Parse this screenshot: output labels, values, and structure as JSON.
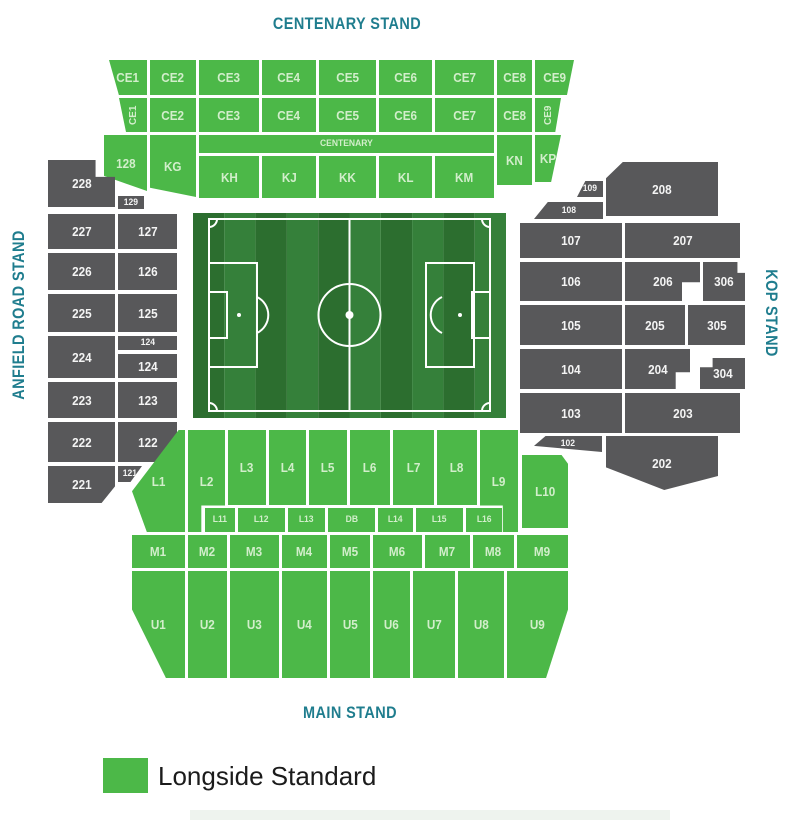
{
  "stands": {
    "centenary": "CENTENARY STAND",
    "main": "MAIN STAND",
    "anfield_road": "ANFIELD ROAD STAND",
    "kop": "KOP STAND"
  },
  "legend": {
    "items": [
      {
        "label": "Longside Standard",
        "color": "#4cb848"
      }
    ]
  },
  "colors": {
    "available": "#4cb848",
    "unavailable": "#58585a",
    "stand_title": "#1f7d8e",
    "label_on_green": "#d2eecb",
    "label_on_gray": "#f4f4f4",
    "pitch_stripe_dark": "#2c6e2f",
    "pitch_stripe_light": "#35803a",
    "pitch_lines": "#ffffff",
    "legend_text": "#1b1b1b"
  },
  "sections": [
    {
      "label": "CE1",
      "x": 109,
      "y": 60,
      "w": 38,
      "h": 35,
      "status": "available",
      "clip": "polygon(0% 0%,100% 0%,100% 100%,26% 100%)"
    },
    {
      "label": "CE2",
      "x": 150,
      "y": 60,
      "w": 46,
      "h": 35,
      "status": "available"
    },
    {
      "label": "CE3",
      "x": 199,
      "y": 60,
      "w": 60,
      "h": 35,
      "status": "available"
    },
    {
      "label": "CE4",
      "x": 262,
      "y": 60,
      "w": 54,
      "h": 35,
      "status": "available"
    },
    {
      "label": "CE5",
      "x": 319,
      "y": 60,
      "w": 57,
      "h": 35,
      "status": "available"
    },
    {
      "label": "CE6",
      "x": 379,
      "y": 60,
      "w": 53,
      "h": 35,
      "status": "available"
    },
    {
      "label": "CE7",
      "x": 435,
      "y": 60,
      "w": 59,
      "h": 35,
      "status": "available"
    },
    {
      "label": "CE8",
      "x": 497,
      "y": 60,
      "w": 35,
      "h": 35,
      "status": "available"
    },
    {
      "label": "CE9",
      "x": 535,
      "y": 60,
      "w": 39,
      "h": 35,
      "status": "available",
      "clip": "polygon(0% 0%,100% 0%,82% 100%,0% 100%)"
    },
    {
      "label": "CE1",
      "x": 119,
      "y": 98,
      "w": 28,
      "h": 34,
      "status": "available",
      "vertical": true,
      "clip": "polygon(0% 0%,100% 0%,100% 100%,25% 100%)"
    },
    {
      "label": "CE2",
      "x": 150,
      "y": 98,
      "w": 46,
      "h": 34,
      "status": "available"
    },
    {
      "label": "CE3",
      "x": 199,
      "y": 98,
      "w": 60,
      "h": 34,
      "status": "available"
    },
    {
      "label": "CE4",
      "x": 262,
      "y": 98,
      "w": 54,
      "h": 34,
      "status": "available"
    },
    {
      "label": "CE5",
      "x": 319,
      "y": 98,
      "w": 57,
      "h": 34,
      "status": "available"
    },
    {
      "label": "CE6",
      "x": 379,
      "y": 98,
      "w": 53,
      "h": 34,
      "status": "available"
    },
    {
      "label": "CE7",
      "x": 435,
      "y": 98,
      "w": 59,
      "h": 34,
      "status": "available"
    },
    {
      "label": "CE8",
      "x": 497,
      "y": 98,
      "w": 35,
      "h": 34,
      "status": "available"
    },
    {
      "label": "CE9",
      "x": 535,
      "y": 98,
      "w": 26,
      "h": 34,
      "status": "available",
      "vertical": true,
      "clip": "polygon(0% 0%,100% 0%,78% 100%,0% 100%)"
    },
    {
      "label": "128",
      "x": 104,
      "y": 135,
      "w": 43,
      "h": 56,
      "status": "available",
      "clip": "polygon(0% 0%,100% 0%,100% 100%,0% 73%)"
    },
    {
      "label": "KG",
      "x": 150,
      "y": 135,
      "w": 46,
      "h": 62,
      "status": "available",
      "clip": "polygon(0% 0%,100% 0%,100% 100%,0% 85%)"
    },
    {
      "label": "CENTENARY",
      "x": 199,
      "y": 135,
      "w": 295,
      "h": 18,
      "status": "available",
      "small": true
    },
    {
      "label": "KH",
      "x": 199,
      "y": 156,
      "w": 60,
      "h": 42,
      "status": "available"
    },
    {
      "label": "KJ",
      "x": 262,
      "y": 156,
      "w": 54,
      "h": 42,
      "status": "available"
    },
    {
      "label": "KK",
      "x": 319,
      "y": 156,
      "w": 57,
      "h": 42,
      "status": "available"
    },
    {
      "label": "KL",
      "x": 379,
      "y": 156,
      "w": 53,
      "h": 42,
      "status": "available"
    },
    {
      "label": "KM",
      "x": 435,
      "y": 156,
      "w": 59,
      "h": 42,
      "status": "available"
    },
    {
      "label": "KN",
      "x": 497,
      "y": 135,
      "w": 35,
      "h": 50,
      "status": "available"
    },
    {
      "label": "KP",
      "x": 535,
      "y": 135,
      "w": 26,
      "h": 47,
      "status": "available",
      "clip": "polygon(0% 0%,100% 0%,62% 100%,0% 100%)"
    },
    {
      "label": "228",
      "x": 48,
      "y": 160,
      "w": 67,
      "h": 47,
      "status": "unavailable",
      "clip": "polygon(0% 0%,71% 0%,71% 36%,100% 36%,100% 100%,0% 100%)"
    },
    {
      "label": "129",
      "x": 118,
      "y": 196,
      "w": 26,
      "h": 13,
      "status": "unavailable",
      "small": true
    },
    {
      "label": "227",
      "x": 48,
      "y": 214,
      "w": 67,
      "h": 35,
      "status": "unavailable"
    },
    {
      "label": "127",
      "x": 118,
      "y": 214,
      "w": 59,
      "h": 35,
      "status": "unavailable"
    },
    {
      "label": "226",
      "x": 48,
      "y": 253,
      "w": 67,
      "h": 37,
      "status": "unavailable"
    },
    {
      "label": "126",
      "x": 118,
      "y": 253,
      "w": 59,
      "h": 37,
      "status": "unavailable"
    },
    {
      "label": "225",
      "x": 48,
      "y": 294,
      "w": 67,
      "h": 38,
      "status": "unavailable"
    },
    {
      "label": "125",
      "x": 118,
      "y": 294,
      "w": 59,
      "h": 38,
      "status": "unavailable"
    },
    {
      "label": "224",
      "x": 48,
      "y": 336,
      "w": 67,
      "h": 42,
      "status": "unavailable"
    },
    {
      "label": "124",
      "x": 118,
      "y": 336,
      "w": 59,
      "h": 14,
      "status": "unavailable",
      "small": true
    },
    {
      "label": "124",
      "x": 118,
      "y": 354,
      "w": 59,
      "h": 24,
      "status": "unavailable"
    },
    {
      "label": "223",
      "x": 48,
      "y": 382,
      "w": 67,
      "h": 36,
      "status": "unavailable"
    },
    {
      "label": "123",
      "x": 118,
      "y": 382,
      "w": 59,
      "h": 36,
      "status": "unavailable"
    },
    {
      "label": "222",
      "x": 48,
      "y": 422,
      "w": 67,
      "h": 40,
      "status": "unavailable"
    },
    {
      "label": "122",
      "x": 118,
      "y": 422,
      "w": 59,
      "h": 40,
      "status": "unavailable",
      "clip": "polygon(0% 0%,100% 0%,100% 48%,66% 100%,0% 100%)"
    },
    {
      "label": "221",
      "x": 48,
      "y": 466,
      "w": 67,
      "h": 37,
      "status": "unavailable",
      "clip": "polygon(0% 0%,100% 0%,100% 55%,80% 100%,0% 100%)"
    },
    {
      "label": "121",
      "x": 118,
      "y": 466,
      "w": 24,
      "h": 16,
      "status": "unavailable",
      "small": true,
      "clip": "polygon(0% 0%,100% 0%,52% 100%,0% 100%)"
    },
    {
      "label": "109",
      "x": 577,
      "y": 181,
      "w": 26,
      "h": 16,
      "status": "unavailable",
      "small": true,
      "clip": "polygon(32% 0%,100% 0%,100% 100%,0% 100%)"
    },
    {
      "label": "208",
      "x": 606,
      "y": 162,
      "w": 112,
      "h": 54,
      "status": "unavailable",
      "clip": "polygon(15% 0%,100% 0%,100% 100%,0% 100%,0% 30%)"
    },
    {
      "label": "108",
      "x": 534,
      "y": 202,
      "w": 69,
      "h": 17,
      "status": "unavailable",
      "small": true,
      "clip": "polygon(20% 0%,100% 0%,100% 100%,0% 100%)"
    },
    {
      "label": "107",
      "x": 520,
      "y": 223,
      "w": 102,
      "h": 35,
      "status": "unavailable"
    },
    {
      "label": "207",
      "x": 625,
      "y": 223,
      "w": 115,
      "h": 35,
      "status": "unavailable"
    },
    {
      "label": "106",
      "x": 520,
      "y": 262,
      "w": 102,
      "h": 39,
      "status": "unavailable"
    },
    {
      "label": "206",
      "x": 625,
      "y": 262,
      "w": 75,
      "h": 39,
      "status": "unavailable",
      "clip": "polygon(0% 0%,100% 0%,100% 52%,76% 52%,76% 100%,0% 100%)"
    },
    {
      "label": "306",
      "x": 703,
      "y": 262,
      "w": 42,
      "h": 39,
      "status": "unavailable",
      "clip": "polygon(0% 0%,82% 0%,82% 28%,100% 28%,100% 100%,0% 100%)"
    },
    {
      "label": "105",
      "x": 520,
      "y": 305,
      "w": 102,
      "h": 40,
      "status": "unavailable"
    },
    {
      "label": "205",
      "x": 625,
      "y": 305,
      "w": 60,
      "h": 40,
      "status": "unavailable"
    },
    {
      "label": "305",
      "x": 688,
      "y": 305,
      "w": 57,
      "h": 40,
      "status": "unavailable"
    },
    {
      "label": "104",
      "x": 520,
      "y": 349,
      "w": 102,
      "h": 40,
      "status": "unavailable"
    },
    {
      "label": "204",
      "x": 625,
      "y": 349,
      "w": 65,
      "h": 40,
      "status": "unavailable",
      "clip": "polygon(0% 0%,100% 0%,100% 58%,78% 58%,78% 100%,0% 100%)"
    },
    {
      "label": "304",
      "x": 700,
      "y": 358,
      "w": 45,
      "h": 31,
      "status": "unavailable",
      "clip": "polygon(0% 30%,28% 30%,28% 0%,100% 0%,100% 100%,0% 100%)"
    },
    {
      "label": "103",
      "x": 520,
      "y": 393,
      "w": 102,
      "h": 40,
      "status": "unavailable"
    },
    {
      "label": "203",
      "x": 625,
      "y": 393,
      "w": 115,
      "h": 40,
      "status": "unavailable"
    },
    {
      "label": "102",
      "x": 534,
      "y": 436,
      "w": 68,
      "h": 16,
      "status": "unavailable",
      "small": true,
      "clip": "polygon(17% 0%,100% 0%,100% 100%,0% 62%)"
    },
    {
      "label": "202",
      "x": 606,
      "y": 436,
      "w": 112,
      "h": 54,
      "status": "unavailable",
      "clip": "polygon(0% 0%,100% 0%,100% 74%,52% 100%,0% 58%)"
    },
    {
      "label": "L1",
      "x": 132,
      "y": 430,
      "w": 53,
      "h": 102,
      "status": "available",
      "clip": "polygon(88% 0%,100% 0%,100% 100%,28% 100%,0% 60%)"
    },
    {
      "label": "L2",
      "x": 188,
      "y": 430,
      "w": 37,
      "h": 102,
      "status": "available",
      "clip": "polygon(0% 0%,100% 0%,100% 74%,36% 74%,36% 100%,0% 100%)"
    },
    {
      "label": "L3",
      "x": 228,
      "y": 430,
      "w": 38,
      "h": 75,
      "status": "available"
    },
    {
      "label": "L4",
      "x": 269,
      "y": 430,
      "w": 37,
      "h": 75,
      "status": "available"
    },
    {
      "label": "L5",
      "x": 309,
      "y": 430,
      "w": 38,
      "h": 75,
      "status": "available"
    },
    {
      "label": "L6",
      "x": 350,
      "y": 430,
      "w": 40,
      "h": 75,
      "status": "available"
    },
    {
      "label": "L7",
      "x": 393,
      "y": 430,
      "w": 41,
      "h": 75,
      "status": "available"
    },
    {
      "label": "L8",
      "x": 437,
      "y": 430,
      "w": 40,
      "h": 75,
      "status": "available"
    },
    {
      "label": "L9",
      "x": 480,
      "y": 430,
      "w": 38,
      "h": 102,
      "status": "available",
      "clip": "polygon(0% 0%,100% 0%,100% 100%,60% 100%,60% 74%,0% 74%)"
    },
    {
      "label": "L10",
      "x": 522,
      "y": 455,
      "w": 46,
      "h": 73,
      "status": "available",
      "clip": "polygon(0% 0%,86% 0%,100% 12%,100% 100%,0% 100%)"
    },
    {
      "label": "L11",
      "x": 205,
      "y": 508,
      "w": 30,
      "h": 24,
      "status": "available",
      "small": true
    },
    {
      "label": "L12",
      "x": 238,
      "y": 508,
      "w": 47,
      "h": 24,
      "status": "available",
      "small": true
    },
    {
      "label": "L13",
      "x": 288,
      "y": 508,
      "w": 37,
      "h": 24,
      "status": "available",
      "small": true
    },
    {
      "label": "DB",
      "x": 328,
      "y": 508,
      "w": 47,
      "h": 24,
      "status": "available",
      "small": true
    },
    {
      "label": "L14",
      "x": 378,
      "y": 508,
      "w": 35,
      "h": 24,
      "status": "available",
      "small": true
    },
    {
      "label": "L15",
      "x": 416,
      "y": 508,
      "w": 47,
      "h": 24,
      "status": "available",
      "small": true
    },
    {
      "label": "L16",
      "x": 466,
      "y": 508,
      "w": 36,
      "h": 24,
      "status": "available",
      "small": true
    },
    {
      "label": "M1",
      "x": 132,
      "y": 535,
      "w": 53,
      "h": 33,
      "status": "available"
    },
    {
      "label": "M2",
      "x": 188,
      "y": 535,
      "w": 39,
      "h": 33,
      "status": "available"
    },
    {
      "label": "M3",
      "x": 230,
      "y": 535,
      "w": 49,
      "h": 33,
      "status": "available"
    },
    {
      "label": "M4",
      "x": 282,
      "y": 535,
      "w": 45,
      "h": 33,
      "status": "available"
    },
    {
      "label": "M5",
      "x": 330,
      "y": 535,
      "w": 40,
      "h": 33,
      "status": "available"
    },
    {
      "label": "M6",
      "x": 373,
      "y": 535,
      "w": 49,
      "h": 33,
      "status": "available"
    },
    {
      "label": "M7",
      "x": 425,
      "y": 535,
      "w": 45,
      "h": 33,
      "status": "available"
    },
    {
      "label": "M8",
      "x": 473,
      "y": 535,
      "w": 41,
      "h": 33,
      "status": "available"
    },
    {
      "label": "M9",
      "x": 517,
      "y": 535,
      "w": 51,
      "h": 33,
      "status": "available"
    },
    {
      "label": "U1",
      "x": 132,
      "y": 571,
      "w": 53,
      "h": 107,
      "status": "available",
      "clip": "polygon(0% 0%,100% 0%,100% 100%,64% 100%,0% 36%)"
    },
    {
      "label": "U2",
      "x": 188,
      "y": 571,
      "w": 39,
      "h": 107,
      "status": "available"
    },
    {
      "label": "U3",
      "x": 230,
      "y": 571,
      "w": 49,
      "h": 107,
      "status": "available"
    },
    {
      "label": "U4",
      "x": 282,
      "y": 571,
      "w": 45,
      "h": 107,
      "status": "available"
    },
    {
      "label": "U5",
      "x": 330,
      "y": 571,
      "w": 40,
      "h": 107,
      "status": "available"
    },
    {
      "label": "U6",
      "x": 373,
      "y": 571,
      "w": 37,
      "h": 107,
      "status": "available"
    },
    {
      "label": "U7",
      "x": 413,
      "y": 571,
      "w": 42,
      "h": 107,
      "status": "available"
    },
    {
      "label": "U8",
      "x": 458,
      "y": 571,
      "w": 46,
      "h": 107,
      "status": "available"
    },
    {
      "label": "U9",
      "x": 507,
      "y": 571,
      "w": 61,
      "h": 107,
      "status": "available",
      "clip": "polygon(0% 0%,100% 0%,100% 36%,64% 100%,0% 100%)"
    }
  ]
}
